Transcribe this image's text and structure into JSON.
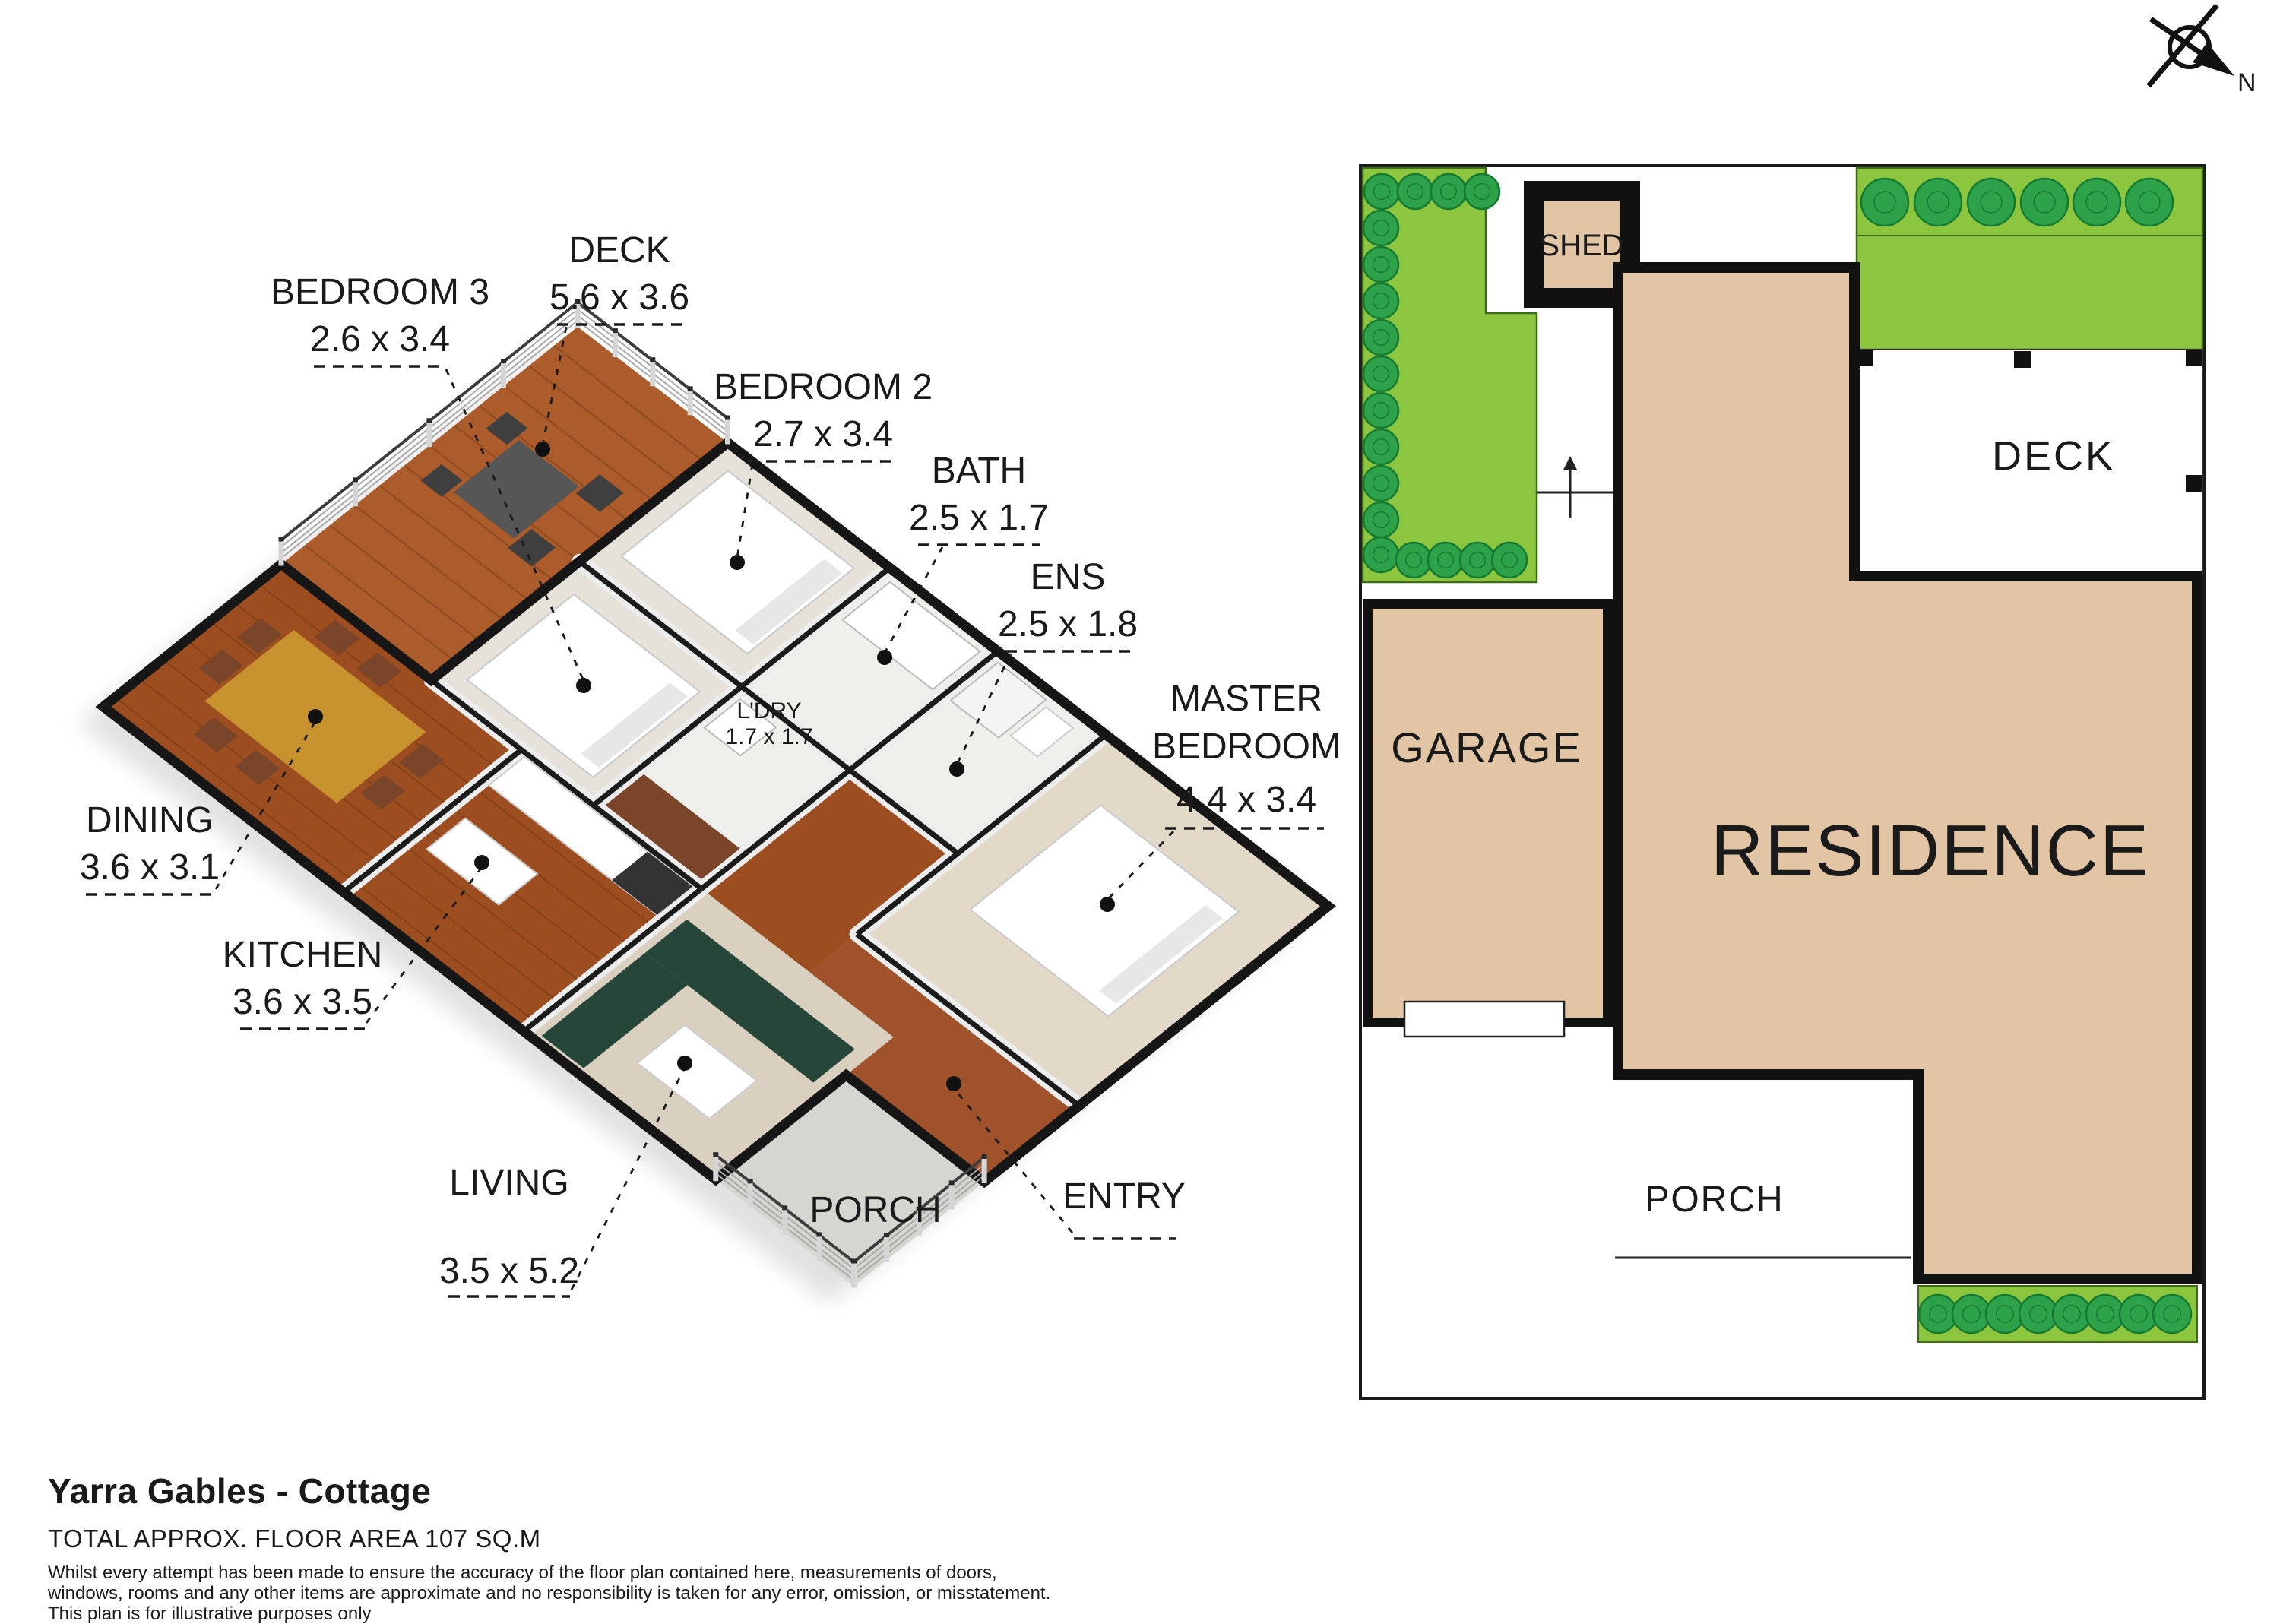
{
  "title_block": {
    "title": "Yarra Gables - Cottage",
    "floor_area": "TOTAL APPROX. FLOOR AREA 107 SQ.M",
    "disclaimer_lines": [
      "Whilst every attempt has been made to ensure the accuracy of the floor plan contained here, measurements of doors,",
      "windows, rooms and any other items are approximate and no responsibility is taken for any error, omission, or misstatement.",
      "This plan is for illustrative purposes only"
    ]
  },
  "compass": {
    "label": "N"
  },
  "floorplan3d": {
    "rooms": [
      {
        "id": "bedroom3",
        "label": "BEDROOM 3",
        "dims": "2.6 x 3.4"
      },
      {
        "id": "deck",
        "label": "DECK",
        "dims": "5.6 x 3.6"
      },
      {
        "id": "bedroom2",
        "label": "BEDROOM 2",
        "dims": "2.7 x 3.4"
      },
      {
        "id": "bath",
        "label": "BATH",
        "dims": "2.5 x 1.7"
      },
      {
        "id": "ens",
        "label": "ENS",
        "dims": "2.5 x 1.8"
      },
      {
        "id": "master_bedroom",
        "label": "MASTER",
        "label2": "BEDROOM",
        "dims": "4.4 x 3.4"
      },
      {
        "id": "ldry",
        "label": "L'DRY",
        "dims": "1.7 x 1.7"
      },
      {
        "id": "dining",
        "label": "DINING",
        "dims": "3.6 x 3.1"
      },
      {
        "id": "kitchen",
        "label": "KITCHEN",
        "dims": "3.6 x 3.5"
      },
      {
        "id": "living",
        "label": "LIVING",
        "dims": "3.5 x 5.2"
      },
      {
        "id": "porch",
        "label": "PORCH"
      },
      {
        "id": "entry",
        "label": "ENTRY"
      }
    ]
  },
  "siteplan": {
    "shed": "SHED",
    "deck": "DECK",
    "garage": "GARAGE",
    "residence": "RESIDENCE",
    "porch": "PORCH"
  },
  "colors": {
    "garden_green": "#8CC63F",
    "tree_green": "#2EA24A",
    "tree_outline": "#157A32",
    "building_tan": "#E2C5A5",
    "wall_black": "#1A1A1A",
    "deck_wood": "#AC5B2A",
    "floor_wood": "#9C4E20",
    "carpet": "#E6E2DA",
    "sofa_green": "#27463A"
  }
}
